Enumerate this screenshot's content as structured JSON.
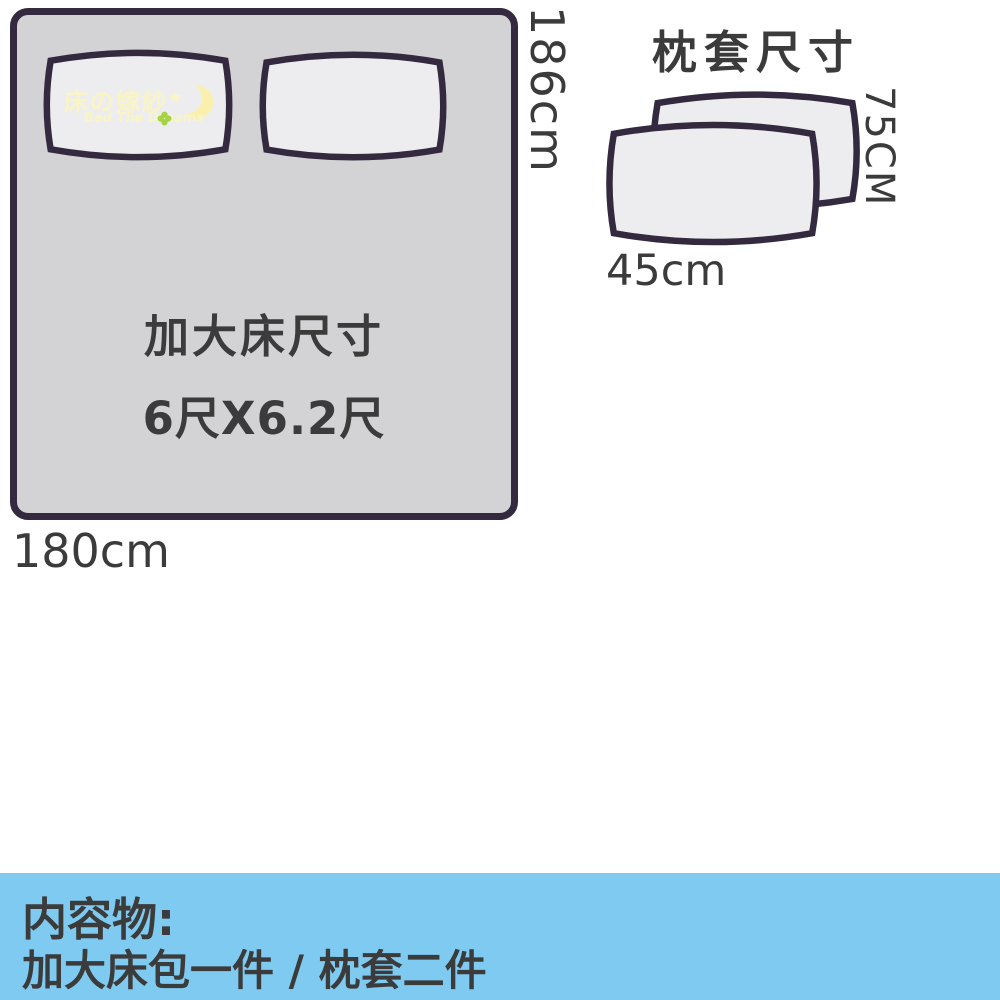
{
  "theme": {
    "bed-fill": "#d3d3d5",
    "pillow-fill": "#ededef",
    "outline": "#332a40",
    "ink": "#3b3b3b",
    "footer-blue": "#7ecaf0",
    "wm-yellow": "#f8f4c6",
    "wm-moon": "#faf0ae",
    "wm-green": "#a6d43e"
  },
  "bed": {
    "size_title": "加大床尺寸",
    "size_value": "6尺X6.2尺",
    "height_label": "186cm",
    "width_label": "180cm"
  },
  "watermark": {
    "brand_cjk": "床の嫁紗",
    "star": "★",
    "brand_en": "Bed The Dreams"
  },
  "pillowcase": {
    "title": "枕套尺寸",
    "height_label": "75CM",
    "width_label": "45cm"
  },
  "footer": {
    "heading": "内容物:",
    "items": "加大床包一件 / 枕套二件"
  }
}
